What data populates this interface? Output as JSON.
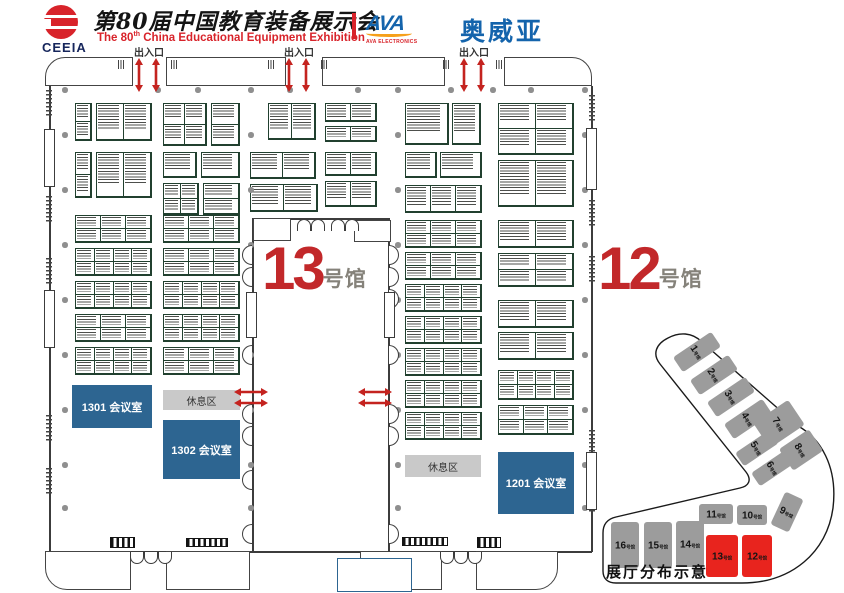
{
  "header": {
    "logo_text": "CEEIA",
    "title_cn": "第80届中国教育装备展示会",
    "title_en_pre": "The 80",
    "title_en_sup": "th",
    "title_en_post": " China Educational Equipment Exhibition",
    "sponsor_logo": "AVA",
    "sponsor_sub": "AVA ELECTRONICS",
    "sponsor_cn": "奥威亚"
  },
  "plan": {
    "entrance_label": "出入口",
    "entrances": [
      148,
      298,
      473
    ],
    "halls": [
      {
        "num": "13",
        "suffix": "号馆"
      },
      {
        "num": "12",
        "suffix": "号馆"
      }
    ],
    "rooms": [
      {
        "label": "1301 会议室"
      },
      {
        "label": "1302 会议室"
      },
      {
        "label": "1201 会议室"
      }
    ],
    "rest_areas": [
      {
        "label": "休息区"
      },
      {
        "label": "休息区"
      }
    ],
    "booths_hall13": [
      [
        75,
        103,
        17,
        38,
        1,
        2
      ],
      [
        96,
        103,
        56,
        38,
        2,
        1
      ],
      [
        163,
        103,
        44,
        43,
        2,
        2
      ],
      [
        211,
        103,
        29,
        43,
        1,
        2
      ],
      [
        268,
        103,
        48,
        37,
        2,
        1
      ],
      [
        325,
        103,
        52,
        19,
        2,
        1
      ],
      [
        325,
        126,
        52,
        16,
        2,
        1
      ],
      [
        75,
        152,
        17,
        46,
        1,
        2
      ],
      [
        96,
        152,
        56,
        46,
        2,
        1
      ],
      [
        163,
        152,
        34,
        26,
        1,
        1
      ],
      [
        201,
        152,
        39,
        26,
        1,
        1
      ],
      [
        163,
        183,
        36,
        32,
        2,
        2
      ],
      [
        203,
        183,
        37,
        32,
        1,
        2
      ],
      [
        250,
        152,
        66,
        27,
        2,
        1
      ],
      [
        250,
        184,
        68,
        28,
        2,
        1
      ],
      [
        325,
        152,
        52,
        24,
        2,
        1
      ],
      [
        325,
        181,
        52,
        26,
        2,
        1
      ],
      [
        75,
        215,
        77,
        28,
        3,
        2
      ],
      [
        163,
        215,
        77,
        28,
        3,
        2
      ],
      [
        75,
        248,
        77,
        28,
        4,
        2
      ],
      [
        163,
        248,
        77,
        28,
        3,
        2
      ],
      [
        75,
        281,
        77,
        28,
        4,
        2
      ],
      [
        163,
        281,
        77,
        28,
        4,
        2
      ],
      [
        75,
        314,
        77,
        28,
        3,
        2
      ],
      [
        163,
        314,
        77,
        28,
        4,
        2
      ],
      [
        75,
        347,
        77,
        28,
        4,
        2
      ],
      [
        163,
        347,
        77,
        28,
        3,
        2
      ]
    ],
    "booths_hall12": [
      [
        405,
        103,
        44,
        42,
        1,
        1
      ],
      [
        452,
        103,
        29,
        42,
        1,
        1
      ],
      [
        405,
        152,
        32,
        26,
        1,
        1
      ],
      [
        440,
        152,
        42,
        26,
        1,
        1
      ],
      [
        405,
        185,
        77,
        28,
        3,
        1
      ],
      [
        405,
        220,
        77,
        28,
        3,
        2
      ],
      [
        405,
        252,
        77,
        28,
        3,
        2
      ],
      [
        405,
        284,
        77,
        28,
        4,
        2
      ],
      [
        405,
        316,
        77,
        28,
        4,
        2
      ],
      [
        405,
        348,
        77,
        28,
        4,
        2
      ],
      [
        405,
        380,
        77,
        28,
        4,
        2
      ],
      [
        405,
        412,
        77,
        28,
        4,
        2
      ],
      [
        498,
        103,
        76,
        52,
        2,
        2
      ],
      [
        498,
        160,
        76,
        47,
        2,
        1
      ],
      [
        498,
        220,
        76,
        28,
        2,
        1
      ],
      [
        498,
        253,
        76,
        34,
        2,
        2
      ],
      [
        498,
        300,
        76,
        28,
        2,
        1
      ],
      [
        498,
        332,
        76,
        28,
        2,
        1
      ],
      [
        498,
        370,
        76,
        30,
        4,
        2
      ],
      [
        498,
        405,
        76,
        30,
        3,
        2
      ]
    ],
    "pillars": {
      "cols": [
        62,
        248,
        395,
        582
      ],
      "rows": [
        132,
        187,
        242,
        297,
        352,
        407,
        462,
        505
      ],
      "top_row_y": 87,
      "top_row_x": [
        62,
        155,
        195,
        248,
        287,
        355,
        395,
        448,
        490,
        528,
        582
      ]
    },
    "corridor_arrows": [
      {
        "x": 234,
        "y": 383
      },
      {
        "x": 234,
        "y": 394
      },
      {
        "x": 358,
        "y": 383
      },
      {
        "x": 358,
        "y": 394
      }
    ]
  },
  "minimap": {
    "caption": "展厅分布示意",
    "hall_suffix": "号馆",
    "halls": [
      {
        "num": "1",
        "x": 697,
        "y": 352,
        "w": 18,
        "h": 46,
        "rot": 56,
        "red": false
      },
      {
        "num": "2",
        "x": 714,
        "y": 375,
        "w": 18,
        "h": 46,
        "rot": 56,
        "red": false
      },
      {
        "num": "3",
        "x": 731,
        "y": 397,
        "w": 18,
        "h": 46,
        "rot": 56,
        "red": false
      },
      {
        "num": "4",
        "x": 748,
        "y": 419,
        "w": 18,
        "h": 46,
        "rot": 56,
        "red": false
      },
      {
        "num": "5",
        "x": 757,
        "y": 448,
        "w": 16,
        "h": 42,
        "rot": 56,
        "red": false
      },
      {
        "num": "6",
        "x": 773,
        "y": 468,
        "w": 16,
        "h": 42,
        "rot": 56,
        "red": false
      },
      {
        "num": "7",
        "x": 779,
        "y": 424,
        "w": 30,
        "h": 42,
        "rot": 56,
        "red": false
      },
      {
        "num": "8",
        "x": 801,
        "y": 450,
        "w": 26,
        "h": 36,
        "rot": 56,
        "red": false
      },
      {
        "num": "9",
        "x": 787,
        "y": 512,
        "w": 20,
        "h": 36,
        "rot": 25,
        "red": false
      },
      {
        "num": "10",
        "x": 752,
        "y": 515,
        "w": 30,
        "h": 20,
        "rot": 0,
        "red": false
      },
      {
        "num": "11",
        "x": 716,
        "y": 514,
        "w": 34,
        "h": 20,
        "rot": 0,
        "red": false
      },
      {
        "num": "12",
        "x": 757,
        "y": 556,
        "w": 30,
        "h": 42,
        "rot": 0,
        "red": true
      },
      {
        "num": "13",
        "x": 722,
        "y": 556,
        "w": 32,
        "h": 42,
        "rot": 0,
        "red": true
      },
      {
        "num": "14",
        "x": 690,
        "y": 544,
        "w": 28,
        "h": 46,
        "rot": 0,
        "red": false
      },
      {
        "num": "15",
        "x": 658,
        "y": 545,
        "w": 28,
        "h": 46,
        "rot": 0,
        "red": false
      },
      {
        "num": "16",
        "x": 625,
        "y": 545,
        "w": 28,
        "h": 46,
        "rot": 0,
        "red": false
      }
    ]
  },
  "colors": {
    "accent_red": "#c4231f",
    "arrow_red": "#c4231f",
    "room_blue": "#2d6591",
    "rest_gray": "#c9c9c9",
    "booth_border": "#21402f",
    "wall": "#3c3c3c",
    "minimap_red": "#e8241e",
    "minimap_gray": "#9c9c9c",
    "brand_blue": "#1464ac",
    "ceeia_red": "#d8232a"
  }
}
